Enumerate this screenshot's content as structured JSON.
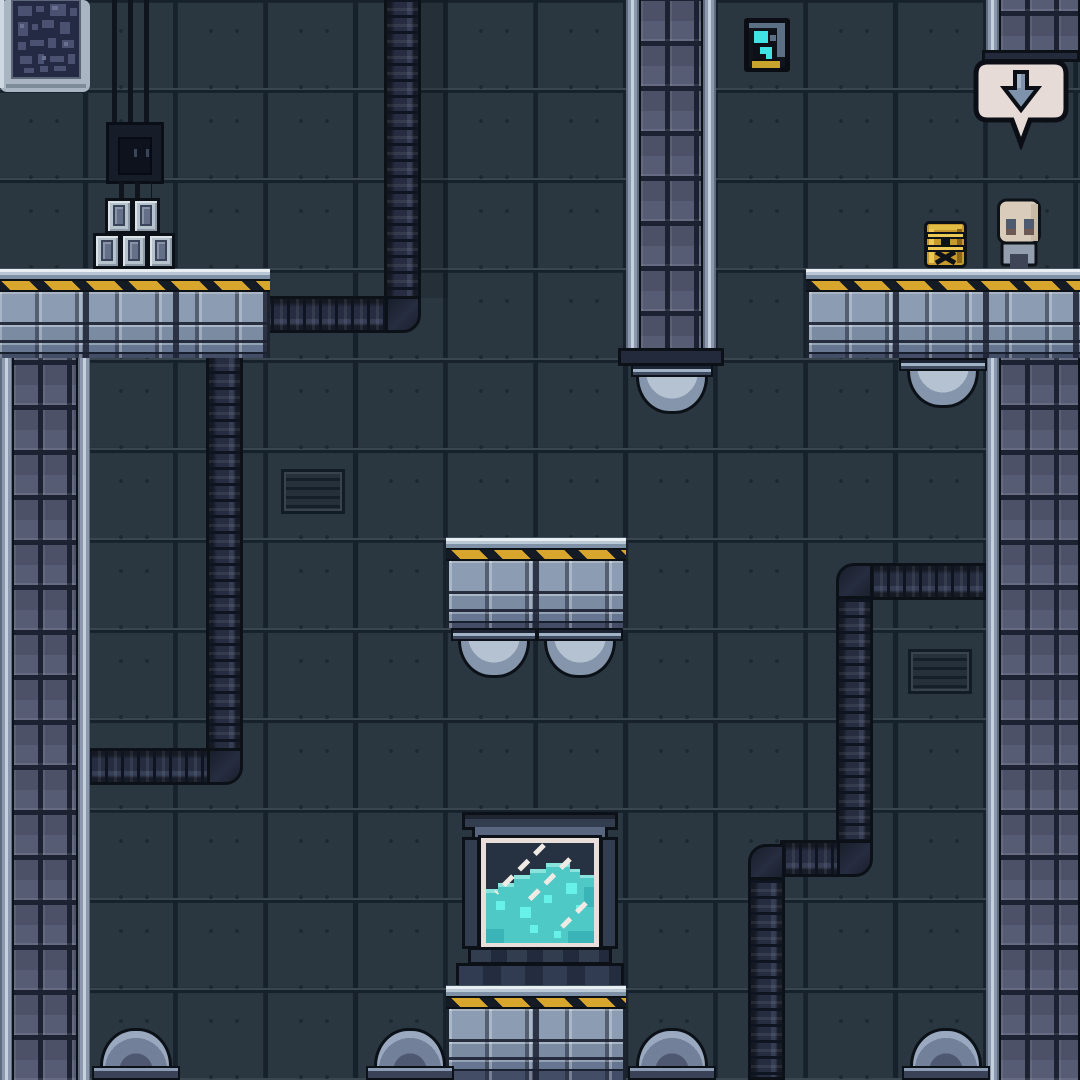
{
  "scene": {
    "title": "sci-fi industrial platformer level",
    "objects": [
      {
        "name": "wall-tiles",
        "label": "riveted metal wall tiles"
      },
      {
        "name": "left-pillar",
        "label": "stone support pillar, left edge"
      },
      {
        "name": "center-pillar",
        "label": "stone support pillar hanging from ceiling"
      },
      {
        "name": "right-pillar",
        "label": "stone support pillar, right edge"
      },
      {
        "name": "pillar-stub",
        "label": "short ceiling pillar stub, top right"
      },
      {
        "name": "platform-top-left",
        "label": "hazard-striped stone platform"
      },
      {
        "name": "platform-right",
        "label": "hazard-striped stone platform"
      },
      {
        "name": "platform-middle",
        "label": "floating hazard-striped platform"
      },
      {
        "name": "platform-bottom",
        "label": "hazard-striped platform under tank"
      },
      {
        "name": "pipe-left",
        "label": "ribbed duct pipe, ceiling to left pillar"
      },
      {
        "name": "pipe-right",
        "label": "ribbed duct pipe, right pillar to floor"
      },
      {
        "name": "dome-lamps",
        "label": "hanging dome lamps"
      },
      {
        "name": "floor-lamps",
        "label": "floor dome lamps"
      },
      {
        "name": "vents",
        "label": "wall ventilation grilles"
      },
      {
        "name": "crates",
        "label": "stacked metal crates"
      },
      {
        "name": "cable-box",
        "label": "cable bundle and junction box"
      },
      {
        "name": "circuit-panel",
        "label": "wall circuit panel"
      },
      {
        "name": "screen-pickup",
        "label": "glowing data-screen collectible"
      },
      {
        "name": "speech-bubble",
        "label": "prompt bubble with down arrow"
      },
      {
        "name": "barrel",
        "label": "yellow hazard barrel"
      },
      {
        "name": "robot-character",
        "label": "beige robot character"
      },
      {
        "name": "liquid-tank",
        "label": "glass tank with cyan liquid"
      }
    ]
  },
  "palette": {
    "bg": "#2a3640",
    "grid": "#17212b",
    "bevel": "#39454f",
    "rivet": "#1e2831",
    "outline": "#0c1118",
    "edge-mid": "#8b98ad",
    "edge-hi": "#c4d0dd",
    "edge-dk": "#5f6c80",
    "rock": "#575c75",
    "rock-bg": "#1d2233",
    "rock-hi": "#6e7389",
    "strip-hi": "#e8eef2",
    "strip-mid": "#b9c8d4",
    "strip-dk": "#7e91a6",
    "hz-y": "#d8a62c",
    "hz-b": "#141b24",
    "brick-hi": "#8c9cb2",
    "brick-mid": "#7b8ba2",
    "brick-dk": "#434d66",
    "brick-gap": "#2e3548",
    "pipe": "#262d40",
    "pipe-dk": "#0f1421",
    "pipe-hi": "#353e55",
    "dome-a": "#b5c2d2",
    "dome-b": "#8595ab",
    "dome-c": "#5d6a84",
    "dome-base": "#3a4257",
    "vent-bg": "#26303b",
    "vent-slat": "#151f2a",
    "vent-bd": "#121c26",
    "crate": "#b6c2cc",
    "crate-panel": "#646f88",
    "cable": "#10151d",
    "box": "#161d29",
    "glass": "#263241",
    "frame": "#e9dfda",
    "tank-dk": "#333d50",
    "tank-md": "#596680",
    "liquid": "#4fc9c6",
    "liquid-hi": "#8ae4de",
    "bubble": "#66f2e8",
    "sb-fill": "#e6dbd7",
    "sb-arrow": "#7e93ab",
    "gold": "#c7a42c",
    "cyan": "#3fe3e6",
    "brl": "#c89a2e",
    "brl-hi": "#ecc854",
    "brl-dk": "#8a6616",
    "skin": "#d9ccba",
    "char-body": "#939fae",
    "char-dk": "#3e4557"
  }
}
